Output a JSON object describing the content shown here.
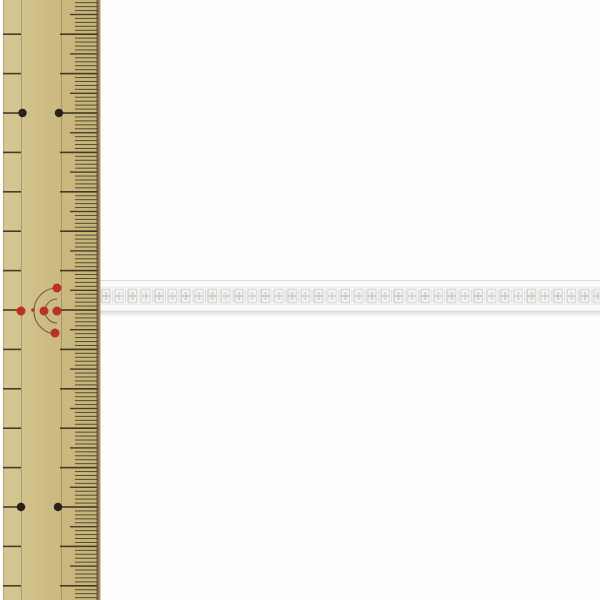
{
  "scene": {
    "type": "product-photo",
    "subject": "white floral lace trim ribbon laid horizontally across a vertical wooden ruler",
    "width": 600,
    "height": 600,
    "background_color": "#fefefe"
  },
  "ruler": {
    "kind": "wooden metric ruler, millimeter graduations, no printed numerals visible",
    "x": 3,
    "width": 96,
    "body_color_left": "#d6c896",
    "body_color_mid": "#cdbc82",
    "body_color_right": "#c5b377",
    "left_edge_color": "#bcab73",
    "right_edge_dark": "#6e5f3f",
    "right_edge_light": "#a3905e",
    "grain_line_color": "rgba(118,100,62,0.45)",
    "grain_line_xs": [
      21,
      61
    ],
    "tick_color": "#3a3222",
    "cm_spacing": 39.4,
    "cm_anchor_y": 113,
    "ticks": {
      "left_line_x1": 3,
      "left_line_x2": 21,
      "cm_x1": 60,
      "halfcm_x1": 70,
      "mm_x1": 75,
      "x2": 97
    },
    "black_dots": {
      "color": "#29221a",
      "radius": 4.2,
      "points": [
        [
          22.5,
          113
        ],
        [
          59,
          113
        ],
        [
          21,
          507
        ],
        [
          58,
          507
        ]
      ]
    },
    "red_ornament": {
      "color": "#bb3129",
      "arc_color": "rgba(88,72,44,0.8)",
      "center": [
        57,
        311
      ],
      "arc_radii": [
        12,
        23
      ],
      "dot_radius": 4.5,
      "dots": [
        [
          57,
          288
        ],
        [
          57,
          311
        ],
        [
          55,
          333
        ],
        [
          44,
          311
        ],
        [
          21,
          311
        ]
      ],
      "small_dot": [
        33,
        310
      ],
      "small_dot_radius": 1.8
    }
  },
  "ribbon": {
    "kind": "white lace trim, repeating square flower motif band between plain woven edges",
    "x": 98,
    "width": 502,
    "top": 280,
    "height": 31.5,
    "band_top_height": 8,
    "band_bottom_height": 7.5,
    "base_color": "#f8f8f6",
    "band_color": "#fbfbfa",
    "edge_line_color": "#dcdcda",
    "inner_line_color": "#e6e6e3",
    "motif_pitch": 13.3,
    "motif_count": 38,
    "motif_frame_color": "#d2d2cf",
    "motif_fill_color": "#f1f1ee",
    "motif_dot_color": "#c7c7c4",
    "separator_color": "#d8d8d5",
    "shadow_color": "rgba(150,150,148,0.32)"
  }
}
